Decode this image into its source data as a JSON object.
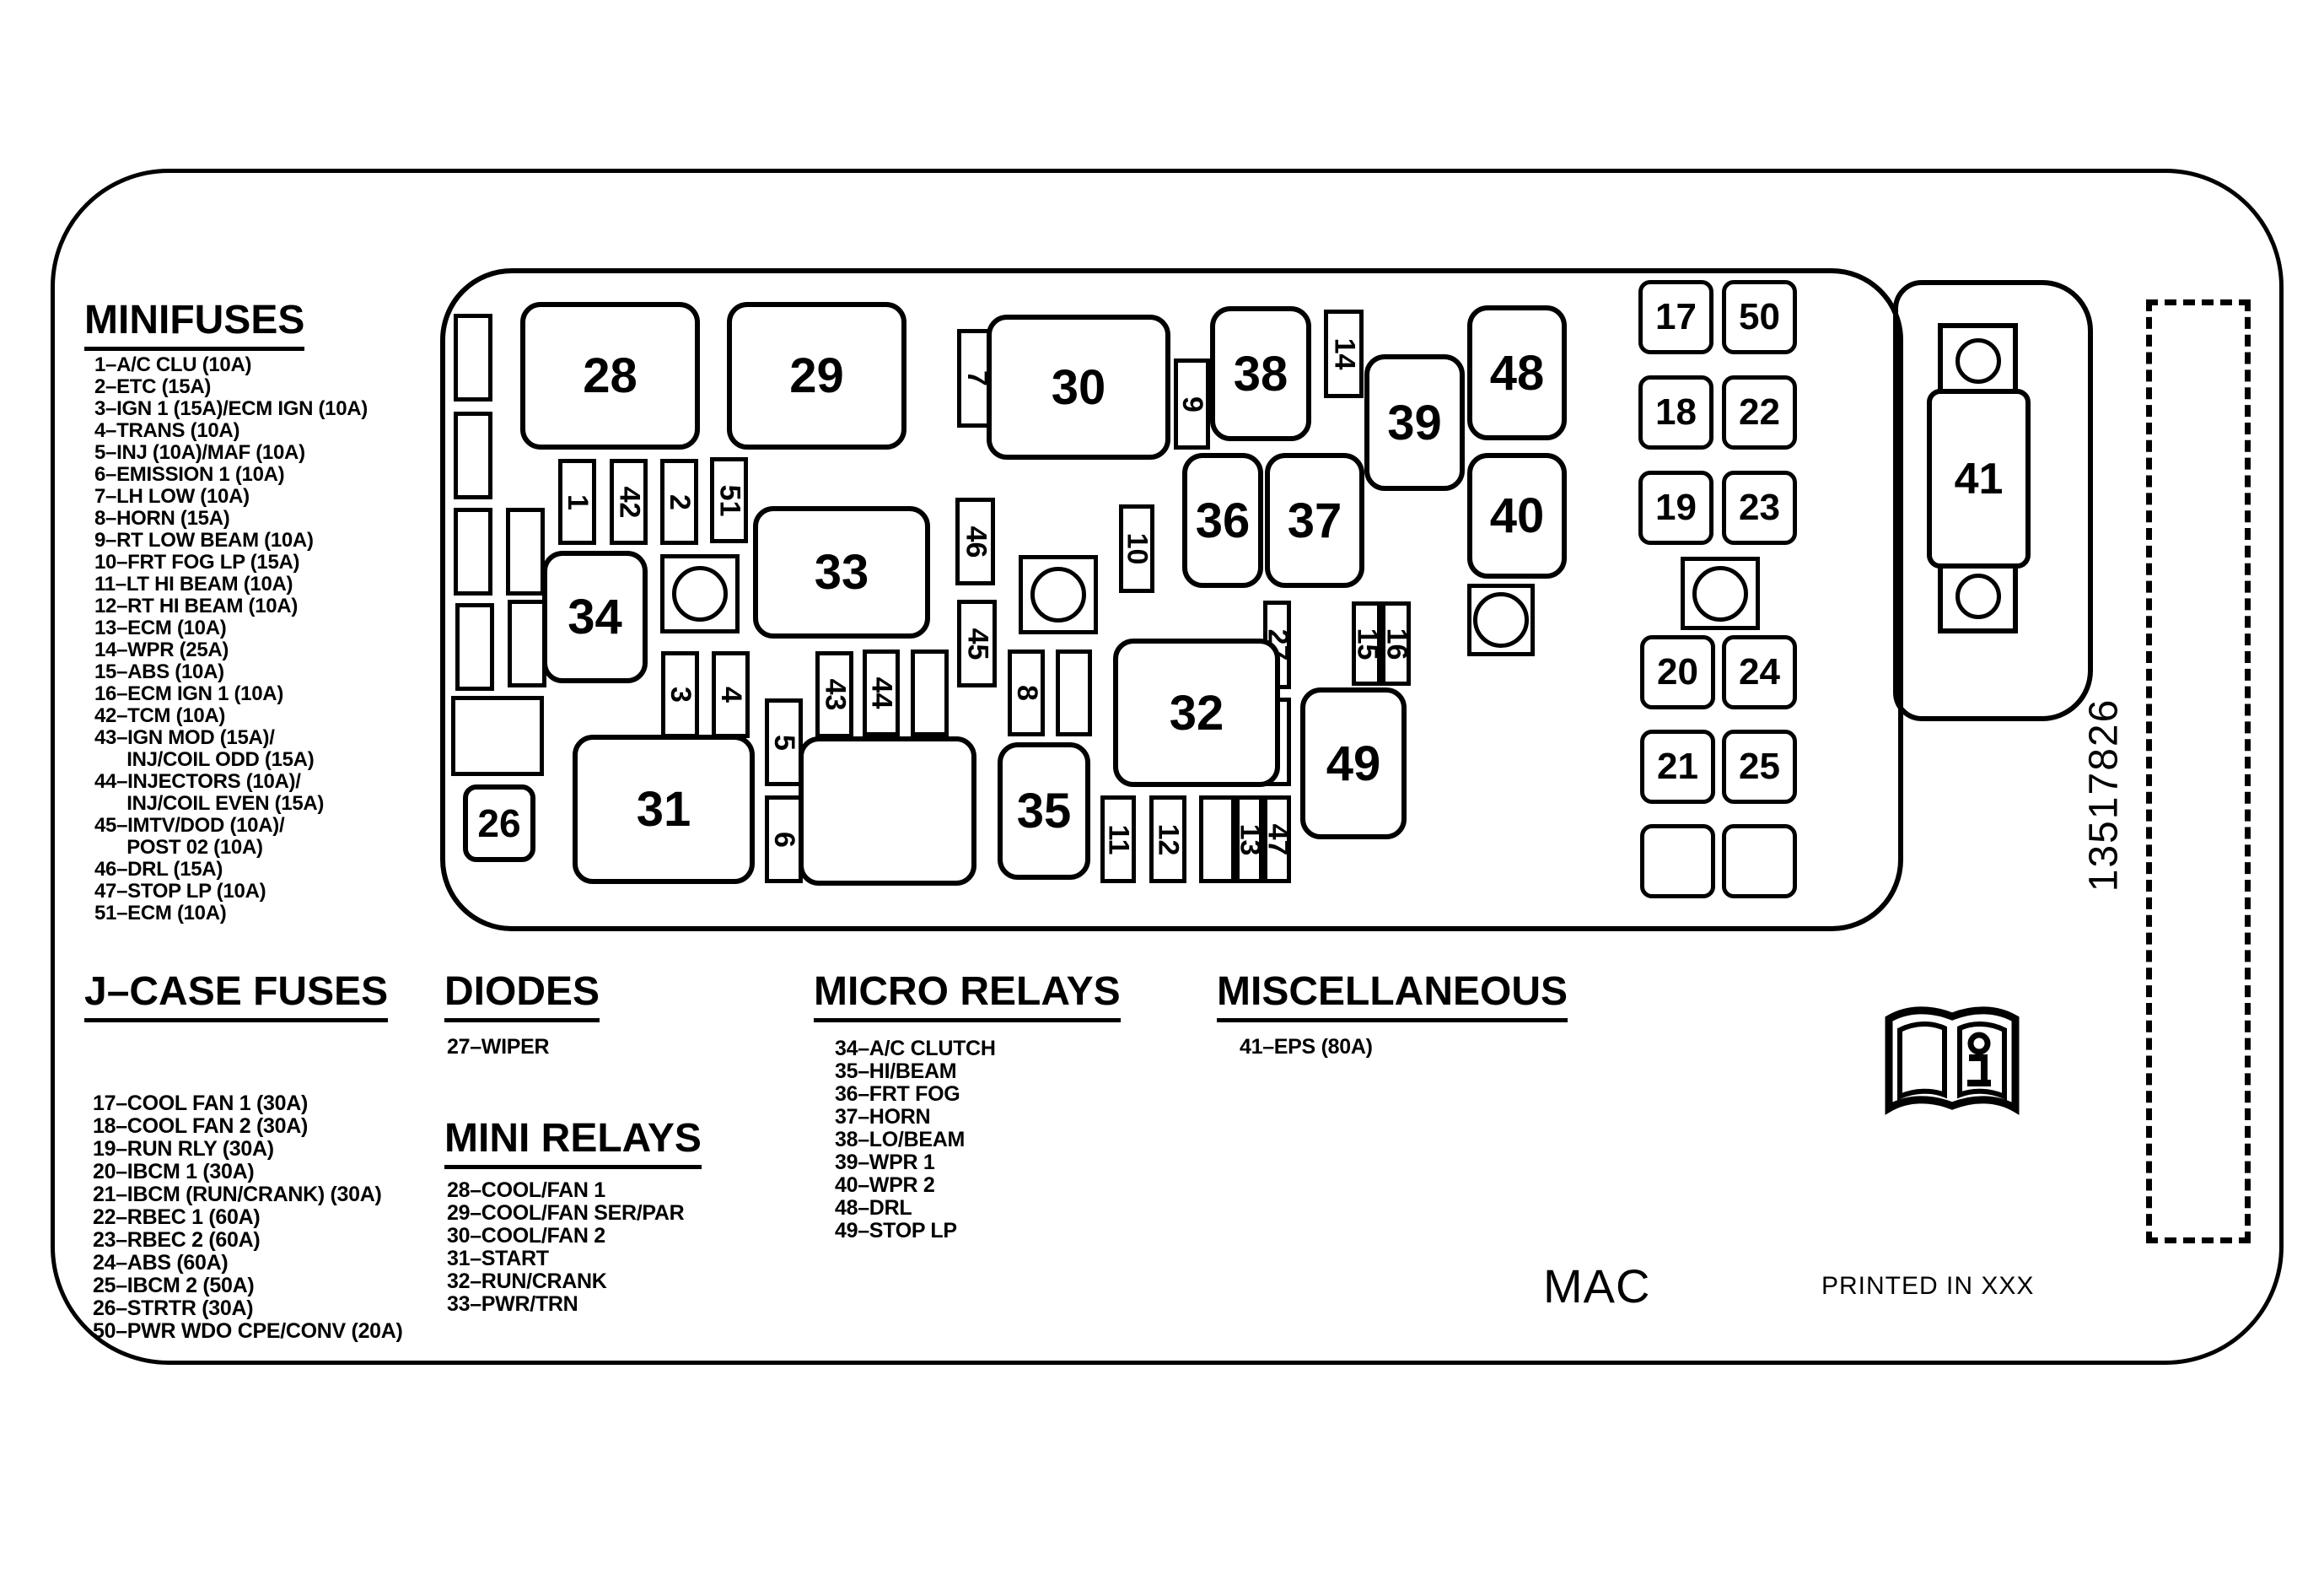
{
  "sections": {
    "minifuses": {
      "title": "MINIFUSES",
      "items": [
        "1–A/C CLU (10A)",
        "2–ETC (15A)",
        "3–IGN 1 (15A)/ECM IGN (10A)",
        "4–TRANS (10A)",
        "5–INJ (10A)/MAF (10A)",
        "6–EMISSION 1 (10A)",
        "7–LH LOW (10A)",
        "8–HORN (15A)",
        "9–RT LOW BEAM (10A)",
        "10–FRT FOG LP (15A)",
        "11–LT HI BEAM (10A)",
        "12–RT HI BEAM (10A)",
        "13–ECM (10A)",
        "14–WPR (25A)",
        "15–ABS (10A)",
        "16–ECM IGN 1 (10A)",
        "42–TCM (10A)",
        "43–IGN MOD (15A)/",
        "      INJ/COIL ODD (15A)",
        "44–INJECTORS (10A)/",
        "      INJ/COIL EVEN (15A)",
        "45–IMTV/DOD (10A)/",
        "      POST 02 (10A)",
        "46–DRL (15A)",
        "47–STOP LP (10A)",
        "51–ECM (10A)"
      ]
    },
    "jcase": {
      "title": "J–CASE FUSES",
      "items": [
        "17–COOL FAN 1 (30A)",
        "18–COOL FAN 2 (30A)",
        "19–RUN RLY (30A)",
        "20–IBCM 1 (30A)",
        "21–IBCM (RUN/CRANK) (30A)",
        "22–RBEC 1 (60A)",
        "23–RBEC 2 (60A)",
        "24–ABS (60A)",
        "25–IBCM 2 (50A)",
        "26–STRTR (30A)",
        "50–PWR WDO CPE/CONV (20A)"
      ]
    },
    "diodes": {
      "title": "DIODES",
      "items": [
        "27–WIPER"
      ]
    },
    "mini_relays": {
      "title": "MINI RELAYS",
      "items": [
        "28–COOL/FAN 1",
        "29–COOL/FAN SER/PAR",
        "30–COOL/FAN 2",
        "31–START",
        "32–RUN/CRANK",
        "33–PWR/TRN"
      ]
    },
    "micro_relays": {
      "title": "MICRO RELAYS",
      "items": [
        "34–A/C CLUTCH",
        "35–HI/BEAM",
        "36–FRT FOG",
        "37–HORN",
        "38–LO/BEAM",
        "39–WPR 1",
        "40–WPR 2",
        "48–DRL",
        "49–STOP LP"
      ]
    },
    "miscellaneous": {
      "title": "MISCELLANEOUS",
      "items": [
        "41–EPS (80A)"
      ]
    }
  },
  "footer": {
    "brand": "MAC",
    "printed": "PRINTED IN XXX"
  },
  "part_number": "13517826",
  "icon": {
    "manual_book": "owner-manual-book-icon"
  },
  "fusebox": {
    "labels": {
      "1": "1",
      "2": "2",
      "3": "3",
      "4": "4",
      "5": "5",
      "6": "6",
      "7": "7",
      "8": "8",
      "9": "9",
      "10": "10",
      "11": "11",
      "12": "12",
      "13": "13",
      "14": "14",
      "15": "15",
      "16": "16",
      "17": "17",
      "18": "18",
      "19": "19",
      "20": "20",
      "21": "21",
      "22": "22",
      "23": "23",
      "24": "24",
      "25": "25",
      "26": "26",
      "27": "27",
      "28": "28",
      "29": "29",
      "30": "30",
      "31": "31",
      "32": "32",
      "33": "33",
      "34": "34",
      "35": "35",
      "36": "36",
      "37": "37",
      "38": "38",
      "39": "39",
      "40": "40",
      "41": "41",
      "42": "42",
      "43": "43",
      "44": "44",
      "45": "45",
      "46": "46",
      "47": "47",
      "48": "48",
      "49": "49",
      "50": "50",
      "51": "51"
    }
  }
}
